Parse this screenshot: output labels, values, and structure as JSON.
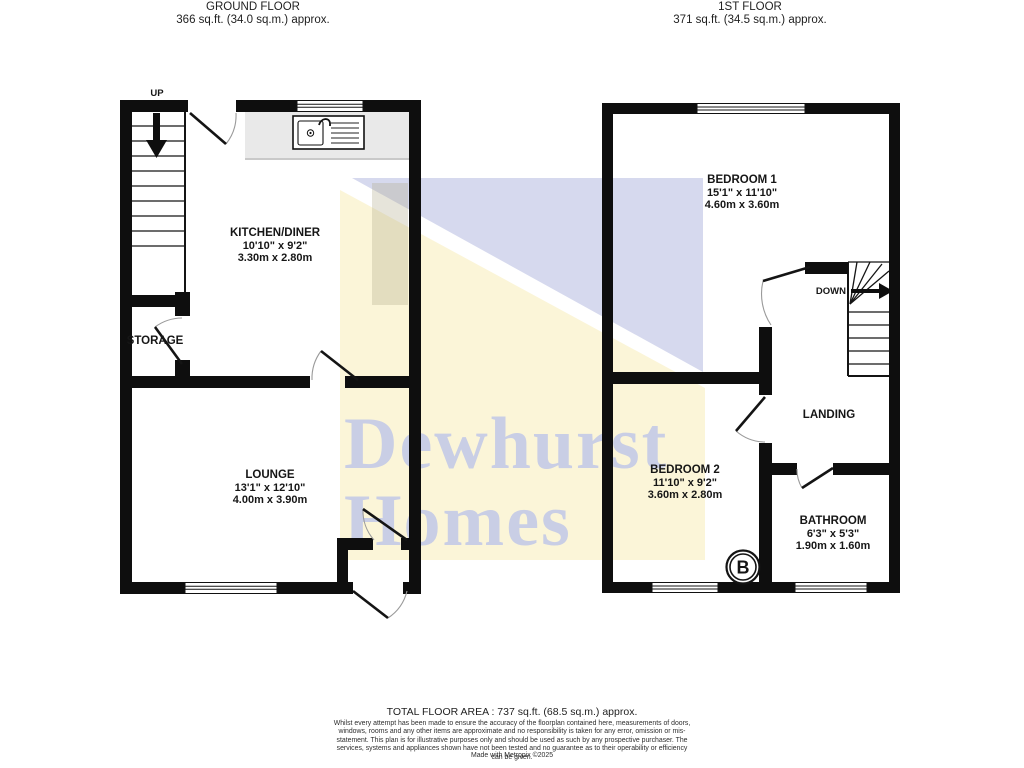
{
  "header": {
    "ground_floor": {
      "title": "GROUND FLOOR",
      "area": "366 sq.ft. (34.0 sq.m.) approx."
    },
    "first_floor": {
      "title": "1ST FLOOR",
      "area": "371 sq.ft. (34.5 sq.m.) approx."
    }
  },
  "watermark": {
    "line1": "Dewhurst",
    "line2": "Homes",
    "text_color": "#c3c9e7",
    "yellow": "#fbf5d8",
    "blue": "#d6d9ee"
  },
  "rooms": {
    "kitchen": {
      "name": "KITCHEN/DINER",
      "imperial": "10'10\" x 9'2\"",
      "metric": "3.30m x 2.80m"
    },
    "lounge": {
      "name": "LOUNGE",
      "imperial": "13'1\" x 12'10\"",
      "metric": "4.00m x 3.90m"
    },
    "storage": {
      "name": "STORAGE"
    },
    "bedroom1": {
      "name": "BEDROOM 1",
      "imperial": "15'1\" x 11'10\"",
      "metric": "4.60m x 3.60m"
    },
    "bedroom2": {
      "name": "BEDROOM 2",
      "imperial": "11'10\" x 9'2\"",
      "metric": "3.60m x 2.80m"
    },
    "landing": {
      "name": "LANDING"
    },
    "bathroom": {
      "name": "BATHROOM",
      "imperial": "6'3\" x 5'3\"",
      "metric": "1.90m x 1.60m"
    }
  },
  "stairs": {
    "up_label": "UP",
    "down_label": "DOWN"
  },
  "boiler_label": "B",
  "footer": {
    "total": "TOTAL FLOOR AREA : 737 sq.ft. (68.5 sq.m.) approx.",
    "disclaimer": "Whilst every attempt has been made to ensure the accuracy of the floorplan contained here, measurements of doors, windows, rooms and any other items are approximate and no responsibility is taken for any error, omission or mis-statement. This plan is for illustrative purposes only and should be used as such by any prospective purchaser. The services, systems and appliances shown have not been tested and no guarantee as to their operability or efficiency can be given.",
    "credit": "Made with Metropix ©2025"
  }
}
